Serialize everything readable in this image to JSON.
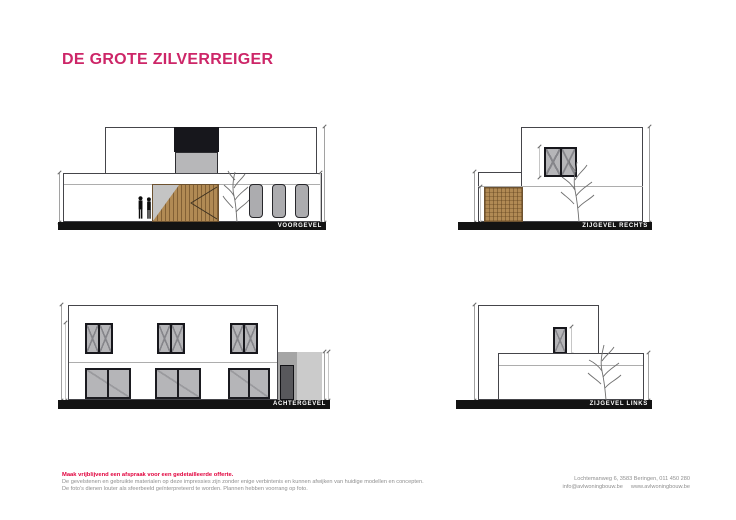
{
  "document": {
    "title": "DE GROTE ZILVERREIGER"
  },
  "elevations": {
    "voorgevel": {
      "label": "VOORGEVEL"
    },
    "zijgevel_rechts": {
      "label": "ZIJGEVEL RECHTS"
    },
    "achtergevel": {
      "label": "ACHTERGEVEL"
    },
    "zijgevel_links": {
      "label": "ZIJGEVEL LINKS"
    }
  },
  "footer": {
    "cta": "Maak vrijblijvend een afspraak voor een gedetailleerde offerte.",
    "disclaimer_line1": "De gevelstenen en gebruikte materialen op deze impressies zijn zonder enige verbintenis en kunnen afwijken van huidige modellen en concepten.",
    "disclaimer_line2": "De foto's dienen louter als sfeerbeeld geïnterpreteerd te worden. Plannen hebben voorrang op foto.",
    "address": "Lochtemanweg 6, 3583 Beringen, 011 450 280",
    "email": "info@avlwoningbouw.be",
    "website": "www.avlwoningbouw.be"
  },
  "colors": {
    "title_pink": "#cd2668",
    "cta_red": "#e1003c",
    "text_gray": "#8f8f8f",
    "wood": "#b18a54",
    "ground_bar": "#131313",
    "window_glass": "#b5b5b8",
    "window_frame": "#17171c"
  }
}
